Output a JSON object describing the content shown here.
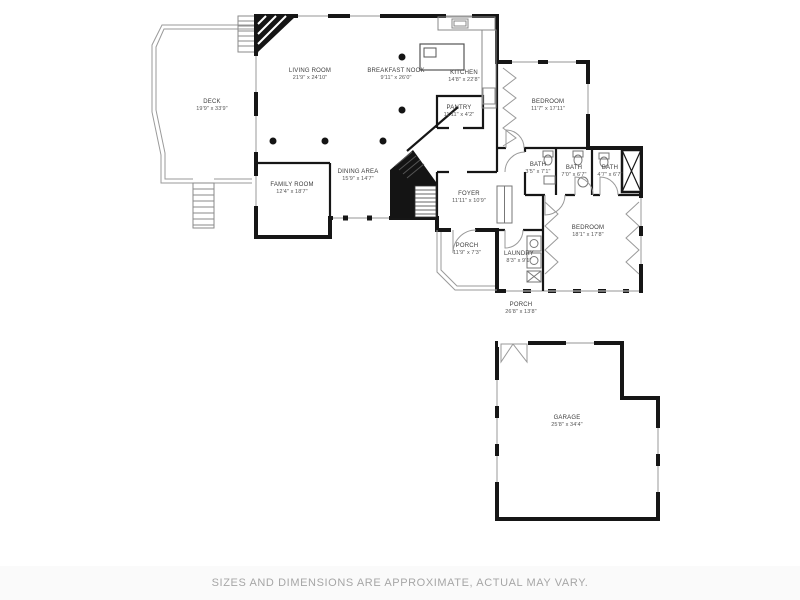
{
  "footer": {
    "disclaimer": "SIZES AND DIMENSIONS ARE APPROXIMATE, ACTUAL MAY VARY."
  },
  "rooms": [
    {
      "label": "DECK",
      "dims": "19'9\" x 33'9\""
    },
    {
      "label": "LIVING ROOM",
      "dims": "21'9\" x 24'10\""
    },
    {
      "label": "BREAKFAST NOOK",
      "dims": "9'11\" x 26'0\""
    },
    {
      "label": "KITCHEN",
      "dims": "14'8\" x 22'8\""
    },
    {
      "label": "PANTRY",
      "dims": "11'11\" x 4'2\""
    },
    {
      "label": "BEDROOM",
      "dims": "11'7\" x 17'11\""
    },
    {
      "label": "FAMILY ROOM",
      "dims": "12'4\" x 18'7\""
    },
    {
      "label": "DINING AREA",
      "dims": "15'9\" x 14'7\""
    },
    {
      "label": "FOYER",
      "dims": "11'11\" x 10'9\""
    },
    {
      "label": "BATH",
      "dims": "3'5\" x 7'1\""
    },
    {
      "label": "BATH",
      "dims": "7'0\" x 6'7\""
    },
    {
      "label": "BATH",
      "dims": "4'7\" x 6'7\""
    },
    {
      "label": "BEDROOM",
      "dims": "18'1\" x 17'8\""
    },
    {
      "label": "PORCH",
      "dims": "11'9\" x 7'3\""
    },
    {
      "label": "LAUNDRY",
      "dims": "8'3\" x 9'1\""
    },
    {
      "label": "PORCH",
      "dims": "26'8\" x 13'8\""
    },
    {
      "label": "GARAGE",
      "dims": "25'8\" x 34'4\""
    }
  ],
  "colors": {
    "wall": "#161616",
    "window": "#aaaaaa",
    "label_text": "#3c3c3c",
    "footer_text": "#a6a6a6",
    "background": "#ffffff"
  }
}
